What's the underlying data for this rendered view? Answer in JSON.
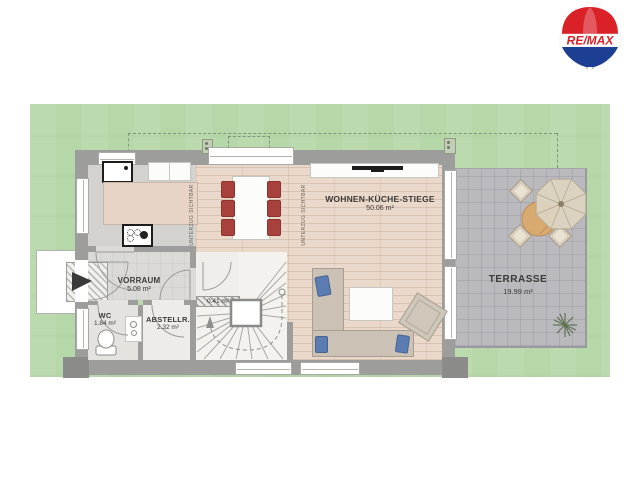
{
  "logo": {
    "brand": "RE/MAX"
  },
  "rooms": {
    "main": {
      "name": "WOHNEN-KÜCHE-STIEGE",
      "area": "50.06 m²"
    },
    "terrace": {
      "name": "TERRASSE",
      "area": "19.99 m²"
    },
    "vorraum": {
      "name": "VORRAUM",
      "area": "5.08 m²"
    },
    "wc": {
      "name": "WC",
      "area": "1.84 m²"
    },
    "storage": {
      "name": "ABSTELLR.",
      "area": "2.32 m²"
    },
    "stair_niche": {
      "area": "0.41 m²"
    }
  },
  "notes": {
    "beam": "UNTERZUG SICHTBAR"
  },
  "colors": {
    "garden": "#b6d8a8",
    "wall": "#9d9d9b",
    "wood_floor": "#ead8ca",
    "terrace_paving": "#bab9be",
    "dining_chair_red": "#a8403c",
    "sofa_cushion_blue": "#5a7cb0",
    "logo_red": "#da2128",
    "logo_blue": "#1c3f94"
  }
}
